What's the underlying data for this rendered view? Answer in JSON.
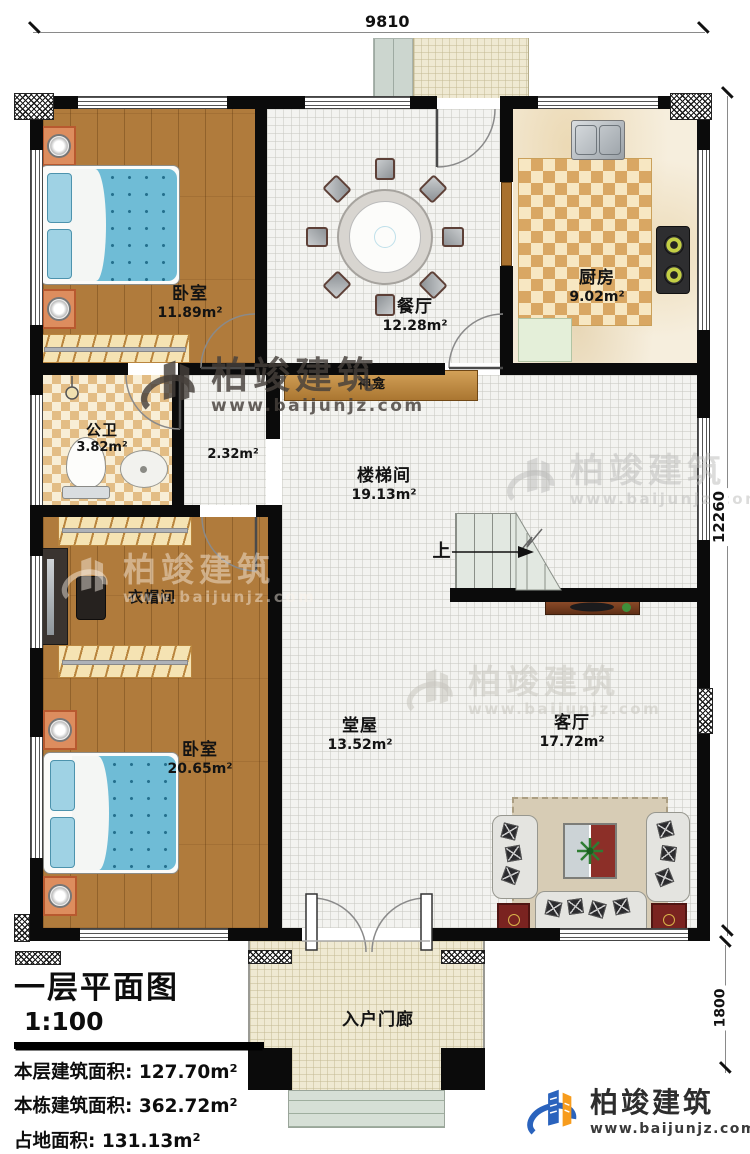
{
  "brand": {
    "name": "柏竣建筑",
    "url": "www.baijunjz.com"
  },
  "plan": {
    "rooms": [
      {
        "name": "卧室",
        "area": "11.89m²"
      },
      {
        "name": "餐厅",
        "area": "12.28m²"
      },
      {
        "name": "厨房",
        "area": "9.02m²"
      },
      {
        "name": "公卫",
        "area": "3.82m²"
      },
      {
        "name": "神龛",
        "area": "2.32m²"
      },
      {
        "name": "楼梯间",
        "area": "19.13m²"
      },
      {
        "name": "衣帽间",
        "area": ""
      },
      {
        "name": "卧室",
        "area": "20.65m²"
      },
      {
        "name": "堂屋",
        "area": "13.52m²"
      },
      {
        "name": "客厅",
        "area": "17.72m²"
      },
      {
        "name": "入户门廊",
        "area": ""
      }
    ],
    "stair_direction_label": "上",
    "dimensions": {
      "top_width": "9810",
      "right_height": "12260",
      "porch_height": "1800"
    }
  },
  "info_panel": {
    "title": "一层平面图",
    "scale": "1:100",
    "rows": [
      {
        "label": "本层建筑面积:",
        "value": "127.70m²"
      },
      {
        "label": "本栋建筑面积:",
        "value": "362.72m²"
      },
      {
        "label": "占地面积:",
        "value": "131.13m²"
      },
      {
        "label": "层高:",
        "value": "3.6m"
      }
    ]
  },
  "colors": {
    "brand_blue": "#2a63bd",
    "brand_orange": "#f79c1d",
    "wood_floor": "#b07b3c",
    "kitchen_tile": "#d9a763",
    "bed_blanket": "#6fbcd6"
  }
}
